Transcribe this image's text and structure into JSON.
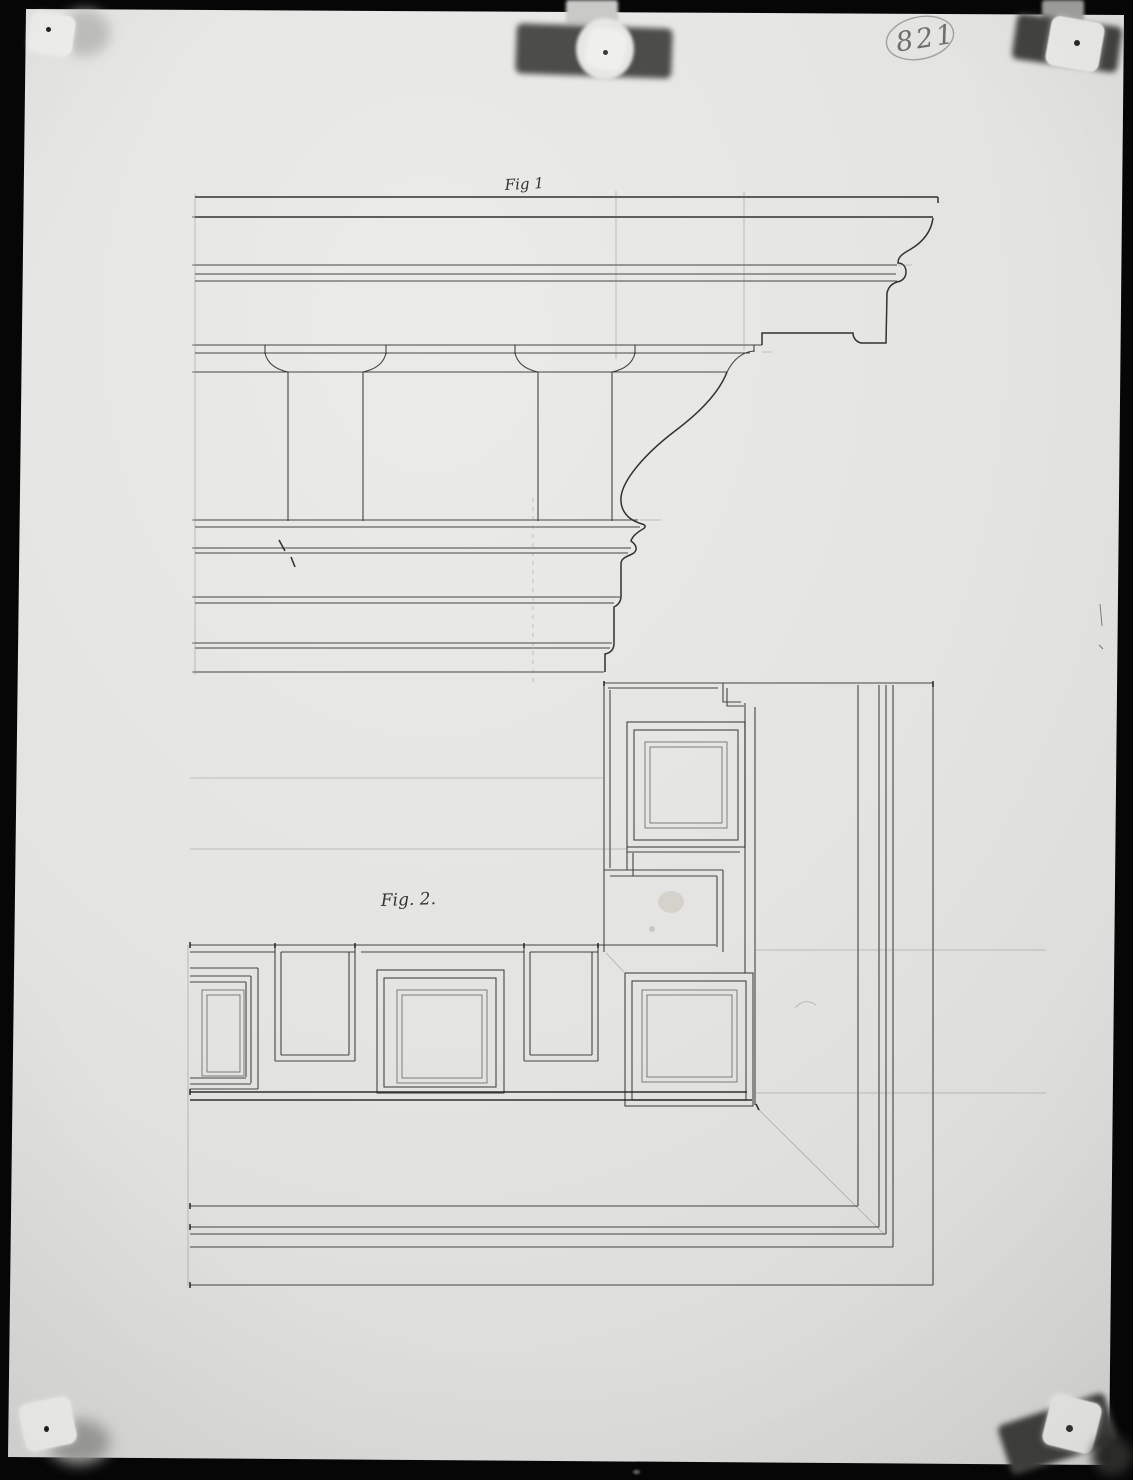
{
  "photo": {
    "annotation": {
      "number": "821"
    },
    "figures": [
      {
        "label": "Fig 1"
      },
      {
        "label": "Fig. 2."
      }
    ],
    "fasteners": {
      "top_left": "push-pin",
      "top_center": "tape-with-pin",
      "top_right": "tape-with-pin",
      "bottom_left": "push-pin",
      "bottom_right": "tape-with-pin"
    },
    "colors": {
      "photo_background": "#060606",
      "paper": "#e3e3e1",
      "ink_line": "#2d2d29",
      "faint_pencil": "#77776f",
      "annotation_pencil": "#6e6e6c",
      "tape": "#4c4c4a",
      "pin_head": "#efefed"
    }
  }
}
